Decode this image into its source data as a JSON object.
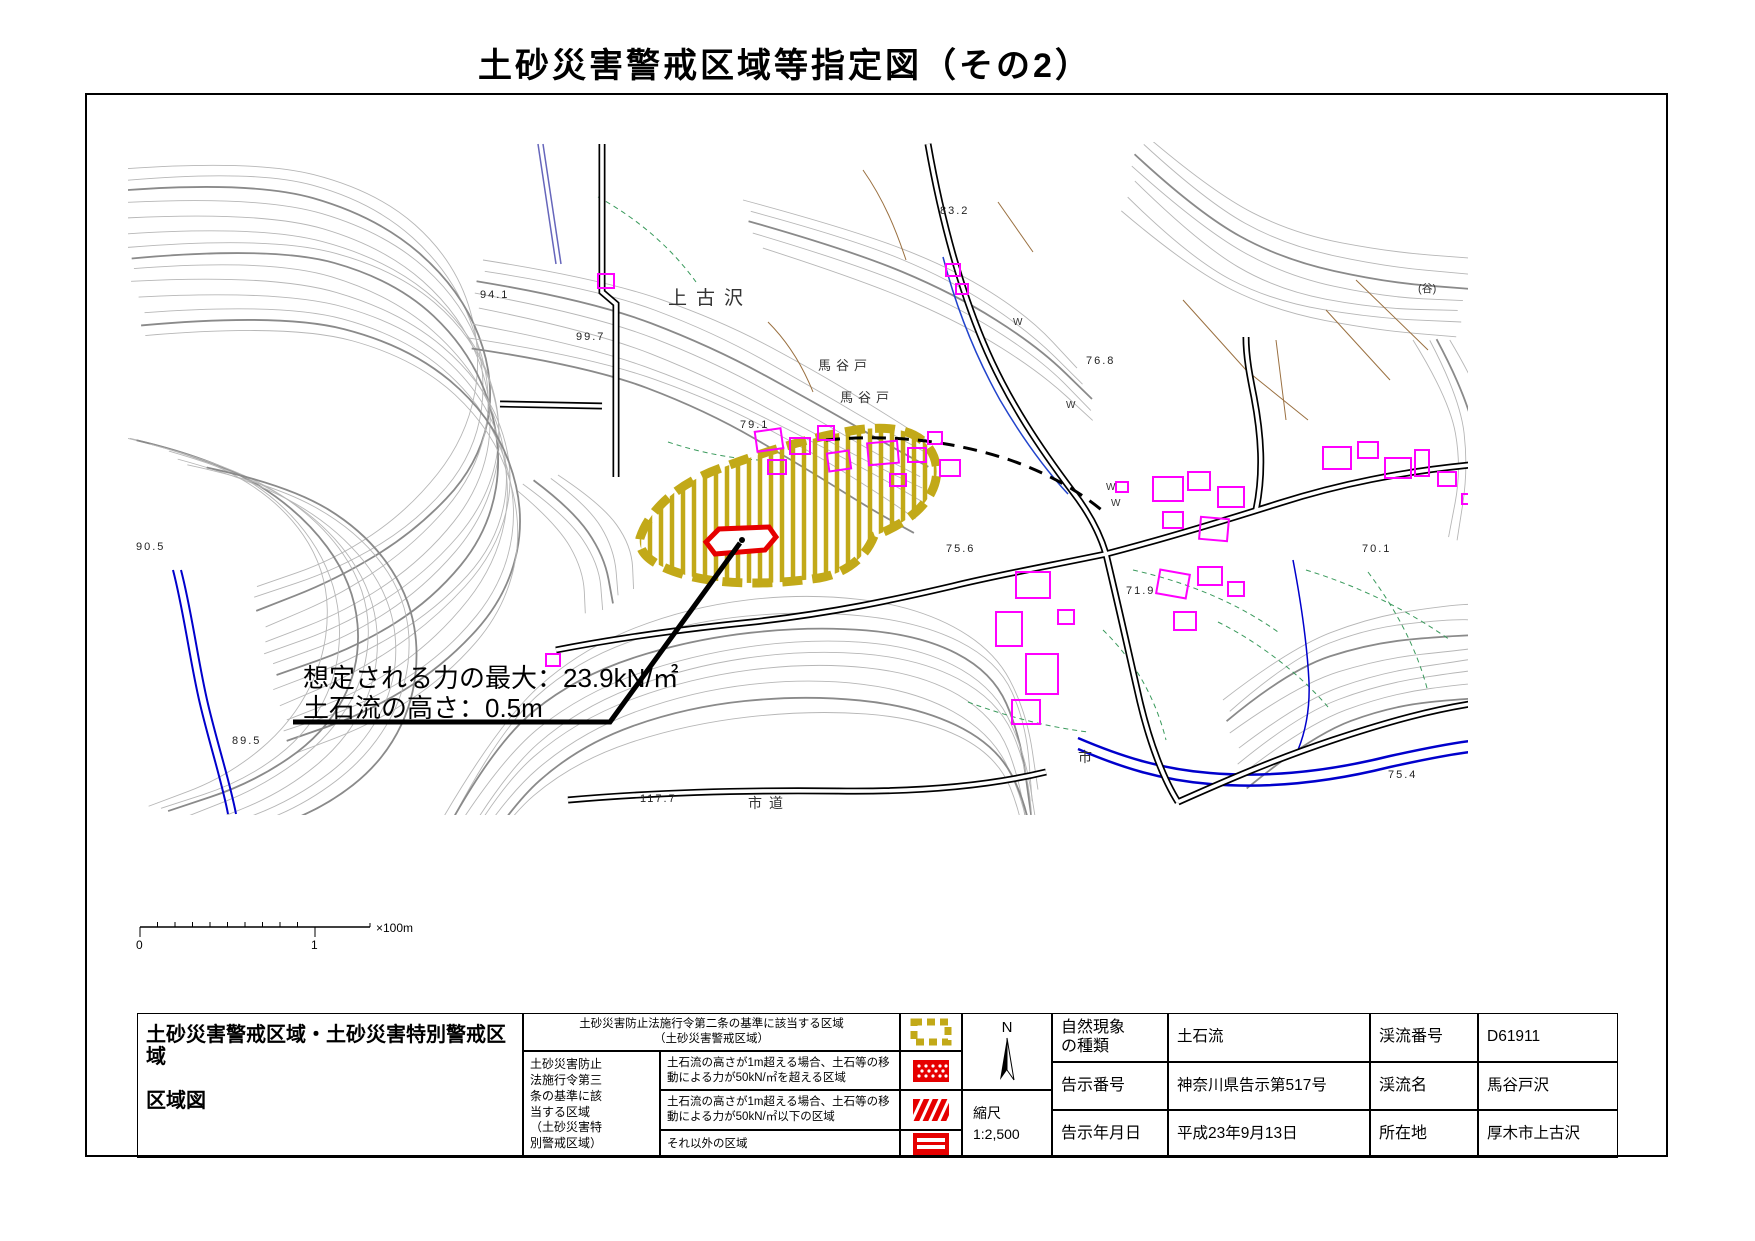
{
  "title": "土砂災害警戒区域等指定図（その2）",
  "map": {
    "annotation_line1": "想定される力の最大：23.9kN/㎡",
    "annotation_line2": "土石流の高さ：0.5m",
    "place_labels": {
      "p1": "上古沢",
      "p2": "馬谷戸",
      "p3": "馬谷戸",
      "p4": "市道",
      "p5": "市",
      "p6": "(谷)",
      "w": "W"
    },
    "elevations": [
      "94.1",
      "99.7",
      "83.2",
      "76.8",
      "75.6",
      "71.9",
      "70.1",
      "75.4",
      "89.5",
      "90.5",
      "117.7",
      "79.1"
    ]
  },
  "scalebar": {
    "start": "0",
    "end": "1",
    "unit": "×100m"
  },
  "legend": {
    "title1": "土砂災害警戒区域・土砂災害特別警戒区域",
    "title2": "区域図",
    "zone_a1": "土砂災害防止法施行令第二条の基準に該当する区域",
    "zone_a2": "（土砂災害警戒区域）",
    "group_label": "土砂災害防止法施行令第三条の基準に該当する区域（土砂災害特別警戒区域）",
    "zone_b": "土石流の高さが1m超える場合、土石等の移動による力が50kN/㎡を超える区域",
    "zone_c": "土石流の高さが1m超える場合、土石等の移動による力が50kN/㎡以下の区域",
    "zone_d": "それ以外の区域"
  },
  "compass": {
    "north": "N"
  },
  "scale": {
    "label": "縮尺",
    "value": "1:2,500"
  },
  "info": {
    "rows": [
      {
        "label1": "自然現象の種類",
        "value1": "土石流",
        "label2": "渓流番号",
        "value2": "D61911"
      },
      {
        "label1": "告示番号",
        "value1": "神奈川県告示第517号",
        "label2": "渓流名",
        "value2": "馬谷戸沢"
      },
      {
        "label1": "告示年月日",
        "value1": "平成23年9月13日",
        "label2": "所在地",
        "value2": "厚木市上古沢"
      }
    ]
  },
  "colors": {
    "warning_yellow": "#c2a918",
    "special_red": "#e60000",
    "building_magenta": "#ff00ff",
    "river_blue": "#0000cc",
    "contour_gray": "#b6b6b6"
  }
}
